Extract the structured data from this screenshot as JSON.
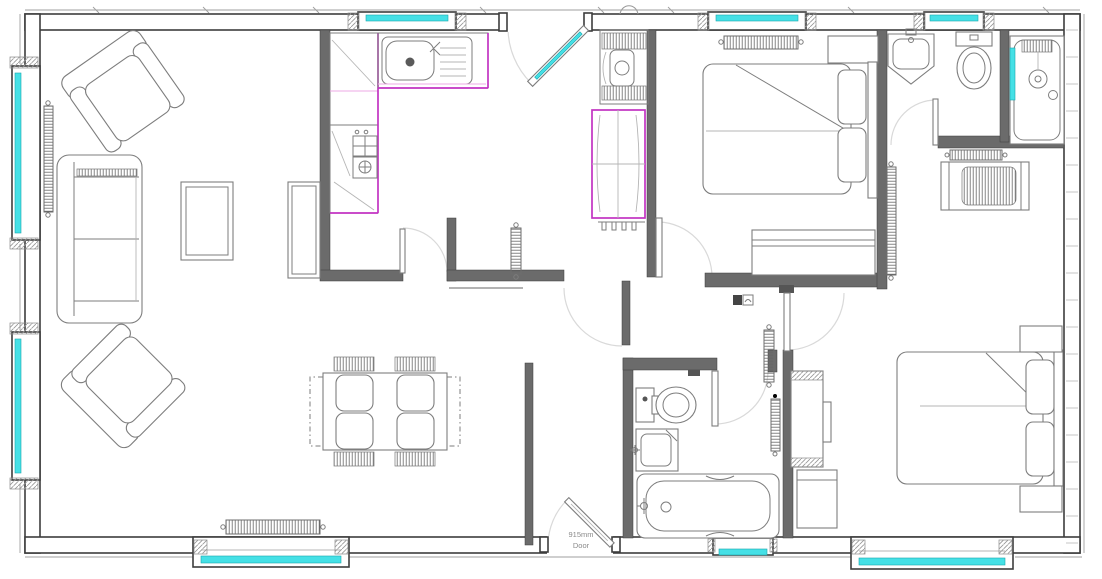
{
  "annotations": {
    "door_label": {
      "line1": "915mm",
      "line2": "Door"
    }
  },
  "colors": {
    "background": "#ffffff",
    "glazing": "#45e0e6",
    "glazing_edge": "#18a7ad",
    "worktop": "#c233c2",
    "worktop_light": "#eeaae4",
    "wall_dark": "#3d3d3d",
    "wall_mid": "#6b6b6b",
    "furniture": "#7d7d7d",
    "furniture_light": "#b5b5b5",
    "arc": "#d9d9d9",
    "hatch": "#9a9a9a",
    "label_text": "#8a8a8a"
  }
}
